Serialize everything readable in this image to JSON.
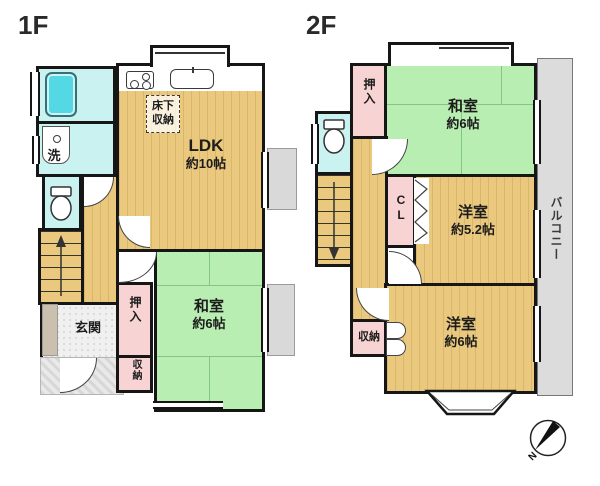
{
  "colors": {
    "floor-tan": "#eac97f",
    "tatami-green": "#b9eeb2",
    "wet-cyan": "#c9f2f1",
    "tub-cyan": "#54d9e4",
    "closet-pink": "#f8d3d3",
    "balcony-gray": "#dcdcdc",
    "wall": "#161616",
    "porch-gray": "#d7d7d7"
  },
  "floor1": {
    "label": "1F",
    "ldk": {
      "line1": "LDK",
      "line2": "約10帖"
    },
    "underfloor": {
      "line1": "床下",
      "line2": "収納"
    },
    "washitsu": {
      "line1": "和室",
      "line2": "約6帖"
    },
    "laundry": "洗",
    "genkan": "玄関",
    "oshiire": "押入",
    "shuno": "収納"
  },
  "floor2": {
    "label": "2F",
    "washitsu": {
      "line1": "和室",
      "line2": "約6帖"
    },
    "western52": {
      "line1": "洋室",
      "line2": "約5.2帖"
    },
    "western6": {
      "line1": "洋室",
      "line2": "約6帖"
    },
    "oshiire": "押入",
    "closet": "CL",
    "shuno": "収納",
    "balcony": "バルコニー"
  },
  "compass": {
    "north": "N"
  }
}
